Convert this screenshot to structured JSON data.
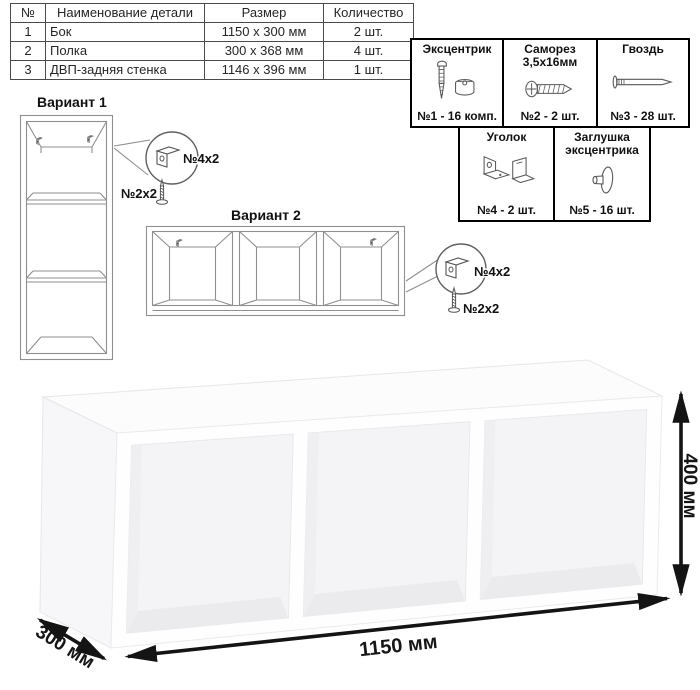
{
  "parts_table": {
    "headers": [
      "№",
      "Наименование детали",
      "Размер",
      "Количество"
    ],
    "rows": [
      {
        "num": "1",
        "name": "Бок",
        "size": "1150 x 300 мм",
        "qty": "2 шт."
      },
      {
        "num": "2",
        "name": "Полка",
        "size": "300 x 368 мм",
        "qty": "4 шт."
      },
      {
        "num": "3",
        "name": "ДВП-задняя стенка",
        "size": "1146 x 396 мм",
        "qty": "1 шт."
      }
    ]
  },
  "hardware": {
    "cells": [
      {
        "title": "Эксцентрик",
        "count": "№1 - 16 комп.",
        "icon": "cam-bolt-icon"
      },
      {
        "title": "Саморез 3,5х16мм",
        "count": "№2 - 2 шт.",
        "icon": "screw-icon"
      },
      {
        "title": "Гвоздь",
        "count": "№3 - 28 шт.",
        "icon": "nail-icon"
      },
      {
        "title": "Уголок",
        "count": "№4 - 2 шт.",
        "icon": "corner-bracket-icon"
      },
      {
        "title": "Заглушка эксцентрика",
        "count": "№5 - 16 шт.",
        "icon": "cam-cap-icon"
      }
    ]
  },
  "variants": {
    "v1": {
      "title": "Вариант 1",
      "bracket_label": "№4х2",
      "screw_label": "№2х2"
    },
    "v2": {
      "title": "Вариант 2",
      "bracket_label": "№4х2",
      "screw_label": "№2х2"
    }
  },
  "dimensions": {
    "width": "1150 мм",
    "depth": "300 мм",
    "height": "400 мм"
  },
  "colors": {
    "line_drawing": "#8f8f8f",
    "dimension_arrow": "#141414",
    "table_border": "#4a4a4a",
    "hardware_border": "#000000"
  }
}
